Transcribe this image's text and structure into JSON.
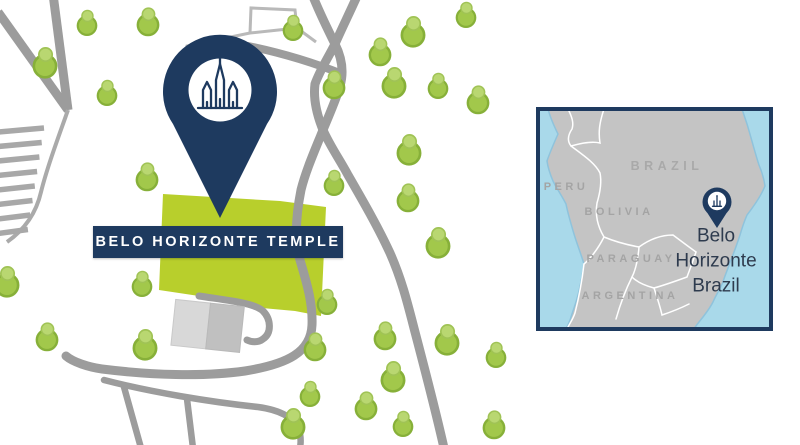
{
  "banner": {
    "label": "BELO HORIZONTE TEMPLE"
  },
  "inset": {
    "countries": [
      {
        "label": "BRAZIL"
      },
      {
        "label": "PERU"
      },
      {
        "label": "BOLIVIA"
      },
      {
        "label": "PARAGUAY"
      },
      {
        "label": "ARGENTINA"
      }
    ],
    "location": {
      "line1": "Belo",
      "line2": "Horizonte",
      "line3": "Brazil"
    }
  },
  "icons": {
    "main_pin": "map-pin-with-temple",
    "inset_pin": "map-pin-with-temple-small",
    "tree": "tree-icon"
  },
  "colors": {
    "navy": "#1e3a5f",
    "property_green": "#b8cf2c",
    "tree_green": "#a2c84b",
    "road_gray": "#9c9c9c",
    "ocean_blue": "#a9d9ea",
    "land_gray": "#c4c4c4",
    "label_gray": "#a4a4a4",
    "location_text": "#2e3b4e"
  }
}
